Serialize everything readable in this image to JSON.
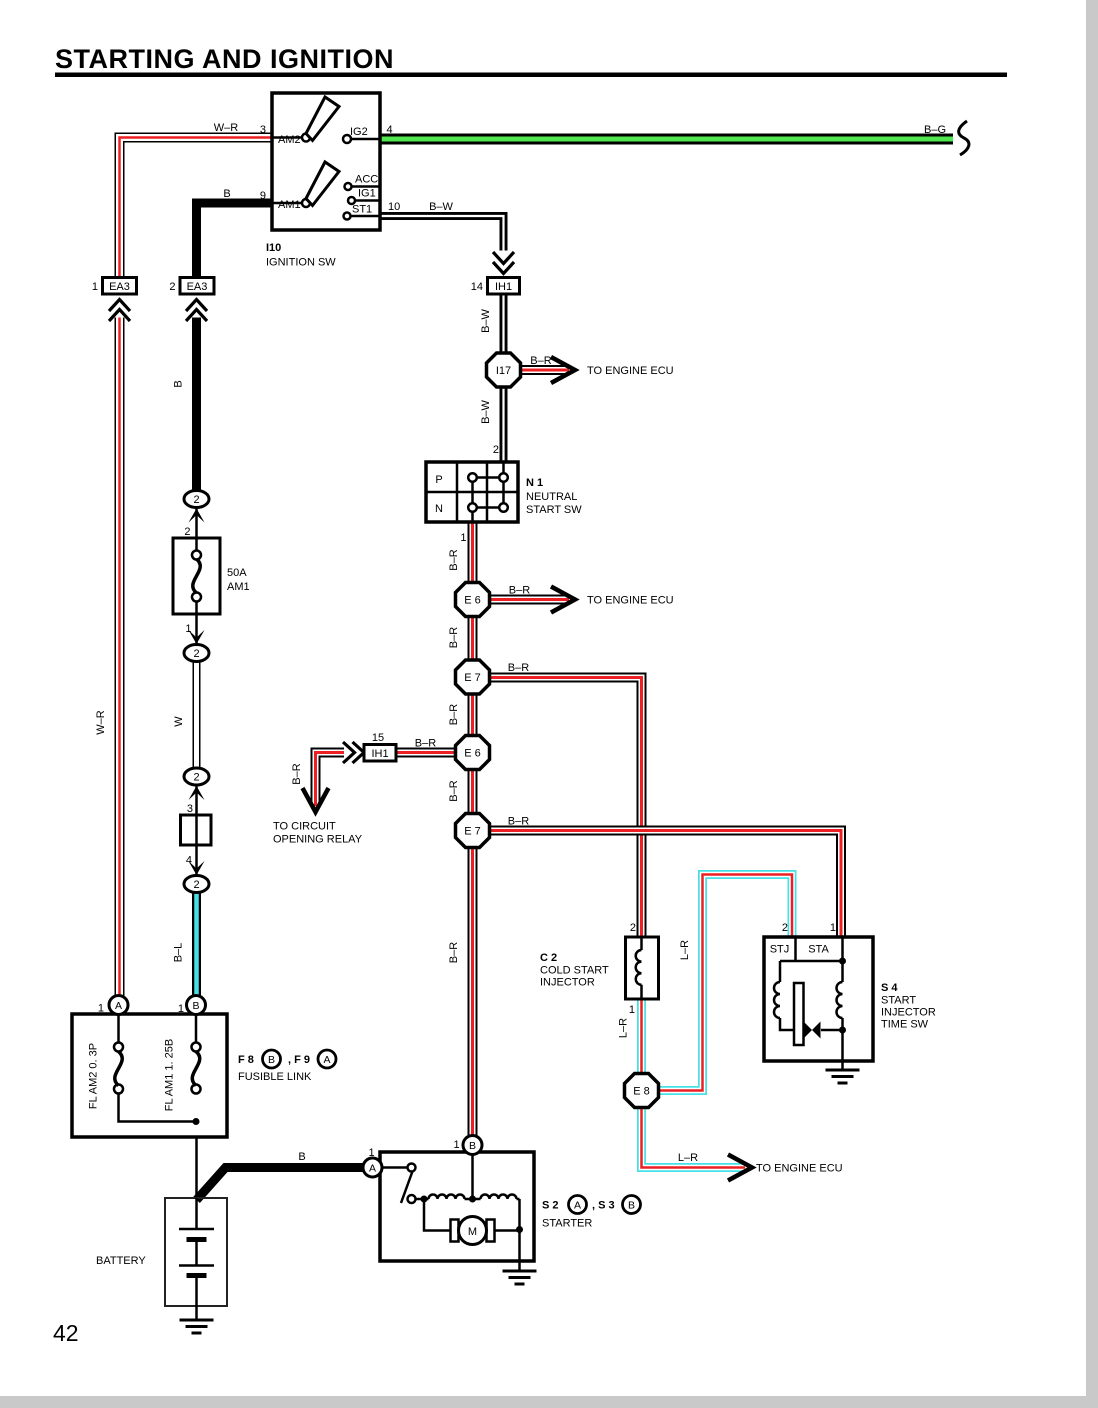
{
  "page": {
    "title": "STARTING AND IGNITION",
    "number": "42"
  },
  "colors": {
    "red": "#ec2024",
    "green": "#50e650",
    "cyan": "#46e1e6"
  },
  "labels": {
    "wr": "W–R",
    "b": "B",
    "bg": "B–G",
    "bw": "B–W",
    "br": "B–R",
    "w": "W",
    "bl": "B–L",
    "lr": "L–R",
    "ecu": "TO ENGINE ECU",
    "relay1": "TO CIRCUIT",
    "relay2": "OPENING RELAY"
  },
  "ign": {
    "pin3": "3",
    "am2": "AM2",
    "ig2": "IG2",
    "pin4": "4",
    "pin9": "9",
    "am1": "AM1",
    "acc": "ACC",
    "ig1": "IG1",
    "st1": "ST1",
    "pin10": "10",
    "id": "I10",
    "name": "IGNITION SW"
  },
  "conn": {
    "pin_ea3l": "1",
    "ea3": "EA3",
    "pin_ea3r": "2",
    "pin_ih1t": "14",
    "ih1": "IH1",
    "pin_ih1m": "15",
    "i17": "I17",
    "e6": "E 6",
    "e7": "E 7",
    "e8": "E 8",
    "oval": "2"
  },
  "chain": {
    "p2": "2",
    "p1": "1",
    "p3": "3",
    "p4": "4"
  },
  "fuse": {
    "rating": "50A",
    "name": "AM1"
  },
  "n1": {
    "pin2": "2",
    "p": "P",
    "n": "N",
    "id": "N 1",
    "l1": "NEUTRAL",
    "l2": "START SW",
    "pin1": "1"
  },
  "fl": {
    "pin_a": "1",
    "a": "A",
    "pin_b": "1",
    "b": "B",
    "left": "FL AM2 0. 3P",
    "right": "FL AM1 1. 25B",
    "ref1": "F 8",
    "badge1": "B",
    "ref2": ", F 9",
    "badge2": "A",
    "caption": "FUSIBLE LINK"
  },
  "bat": {
    "name": "BATTERY"
  },
  "str": {
    "pin_a": "1",
    "a": "A",
    "pin_b": "1",
    "b": "B",
    "m": "M",
    "ref1": "S 2",
    "badge1": "A",
    "ref2": ", S 3",
    "badge2": "B",
    "name": "STARTER"
  },
  "c2": {
    "pin2": "2",
    "pin1": "1",
    "id": "C 2",
    "l1": "COLD START",
    "l2": "INJECTOR"
  },
  "s4": {
    "pin2": "2",
    "pin1": "1",
    "stj": "STJ",
    "sta": "STA",
    "id": "S 4",
    "l1": "START",
    "l2": "INJECTOR",
    "l3": "TIME SW"
  }
}
